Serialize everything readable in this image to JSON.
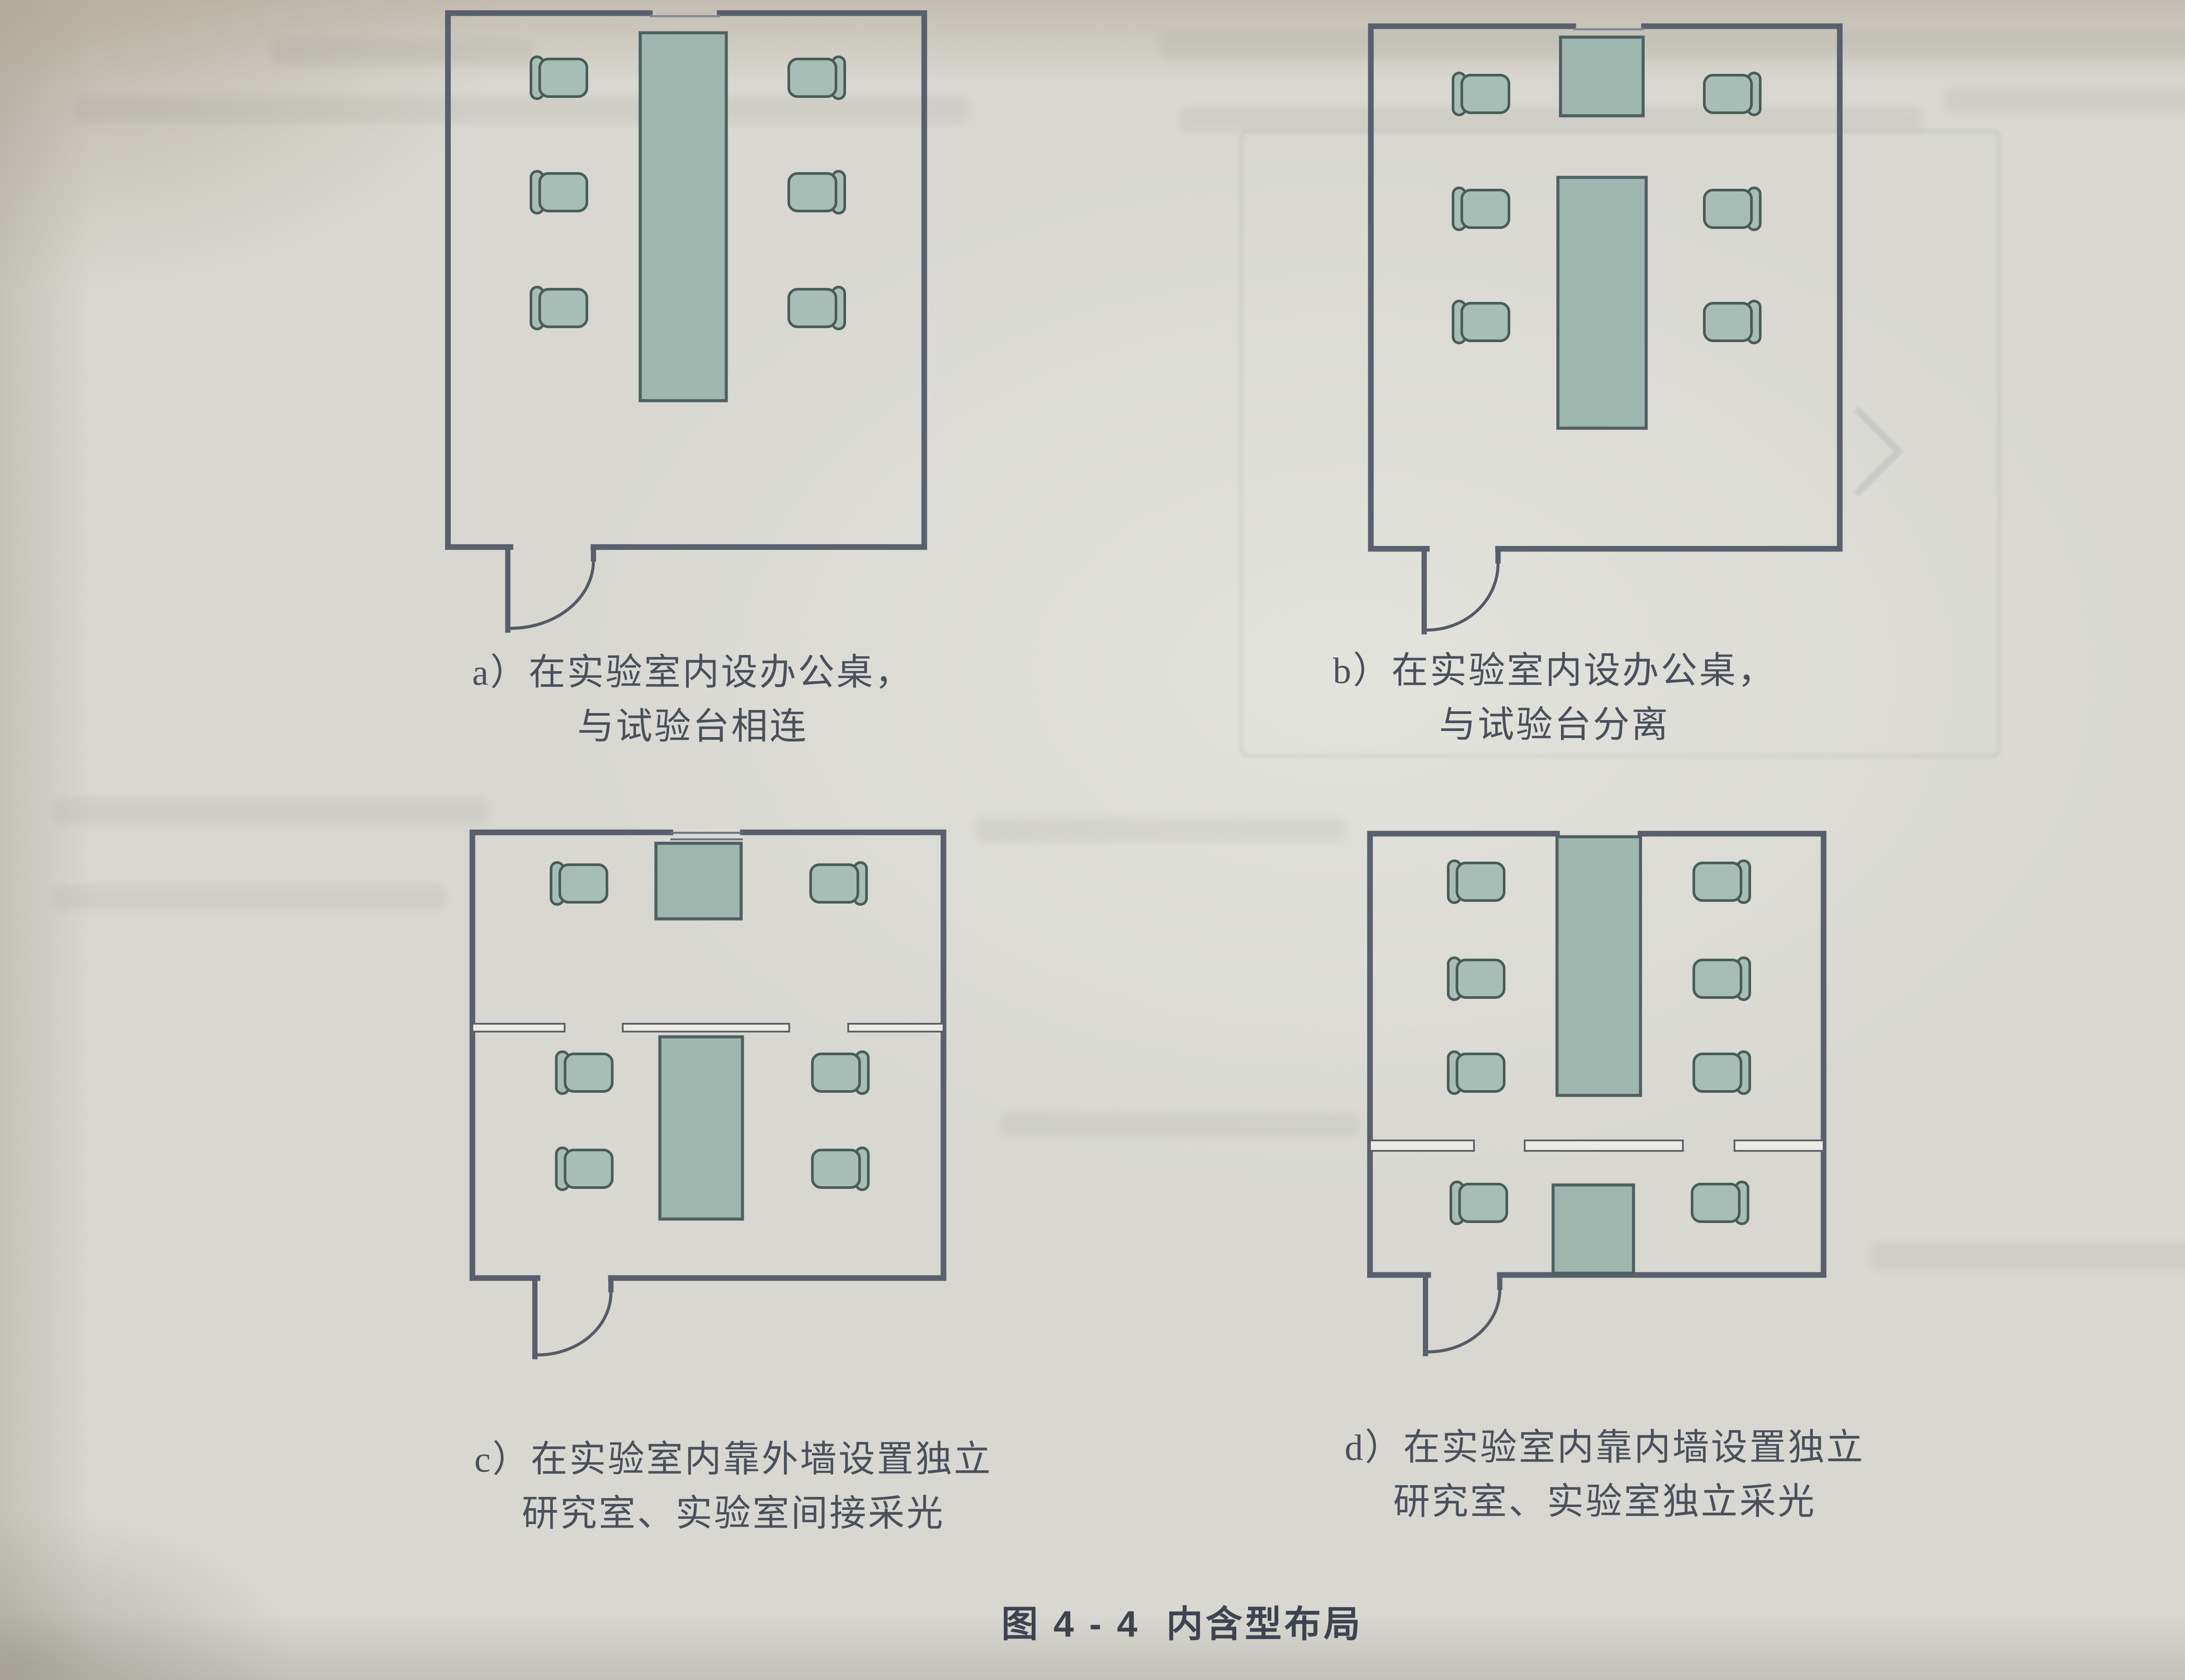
{
  "figure_caption": {
    "label": "图 4 - 4",
    "title": "内含型布局"
  },
  "panels": [
    {
      "id": "a",
      "caption_line1": "a）在实验室内设办公桌，",
      "caption_line2": "与试验台相连",
      "depicted": "room with long bench attached to top wall, 3 chairs each side, door at bottom-left",
      "chair_count": 6,
      "bench_count": 1,
      "desk_count": 0,
      "partition": false,
      "door": "bottom-left"
    },
    {
      "id": "b",
      "caption_line1": "b）在实验室内设办公桌，",
      "caption_line2": "与试验台分离",
      "depicted": "room with small desk at top wall and separate free-standing bench, 3 chairs each side, door at bottom-left",
      "chair_count": 6,
      "bench_count": 1,
      "desk_count": 1,
      "partition": false,
      "door": "bottom-left"
    },
    {
      "id": "c",
      "caption_line1": "c）在实验室内靠外墙设置独立",
      "caption_line2": "研究室、实验室间接采光",
      "depicted": "partition below top zone forms research room at outer wall with desk and 2 chairs; lab bench hangs from partition with 4 chairs; door at bottom-left",
      "chair_count": 6,
      "bench_count": 1,
      "desk_count": 1,
      "partition": true,
      "door": "bottom-left"
    },
    {
      "id": "d",
      "caption_line1": "d）在实验室内靠内墙设置独立",
      "caption_line2": "研究室、实验室独立采光",
      "depicted": "lab with long bench from top wall and 6 chairs; partition near bottom forms research room at inner wall with desk and 2 chairs; door at bottom-left",
      "chair_count": 8,
      "bench_count": 1,
      "desk_count": 1,
      "partition": true,
      "door": "bottom-left"
    }
  ],
  "colors": {
    "paper": "#d8d7d1",
    "wall": "#5a5f6d",
    "furniture_fill": "#9db7af",
    "furniture_stroke": "#4f5f62",
    "caption_text": "#4a505c"
  }
}
